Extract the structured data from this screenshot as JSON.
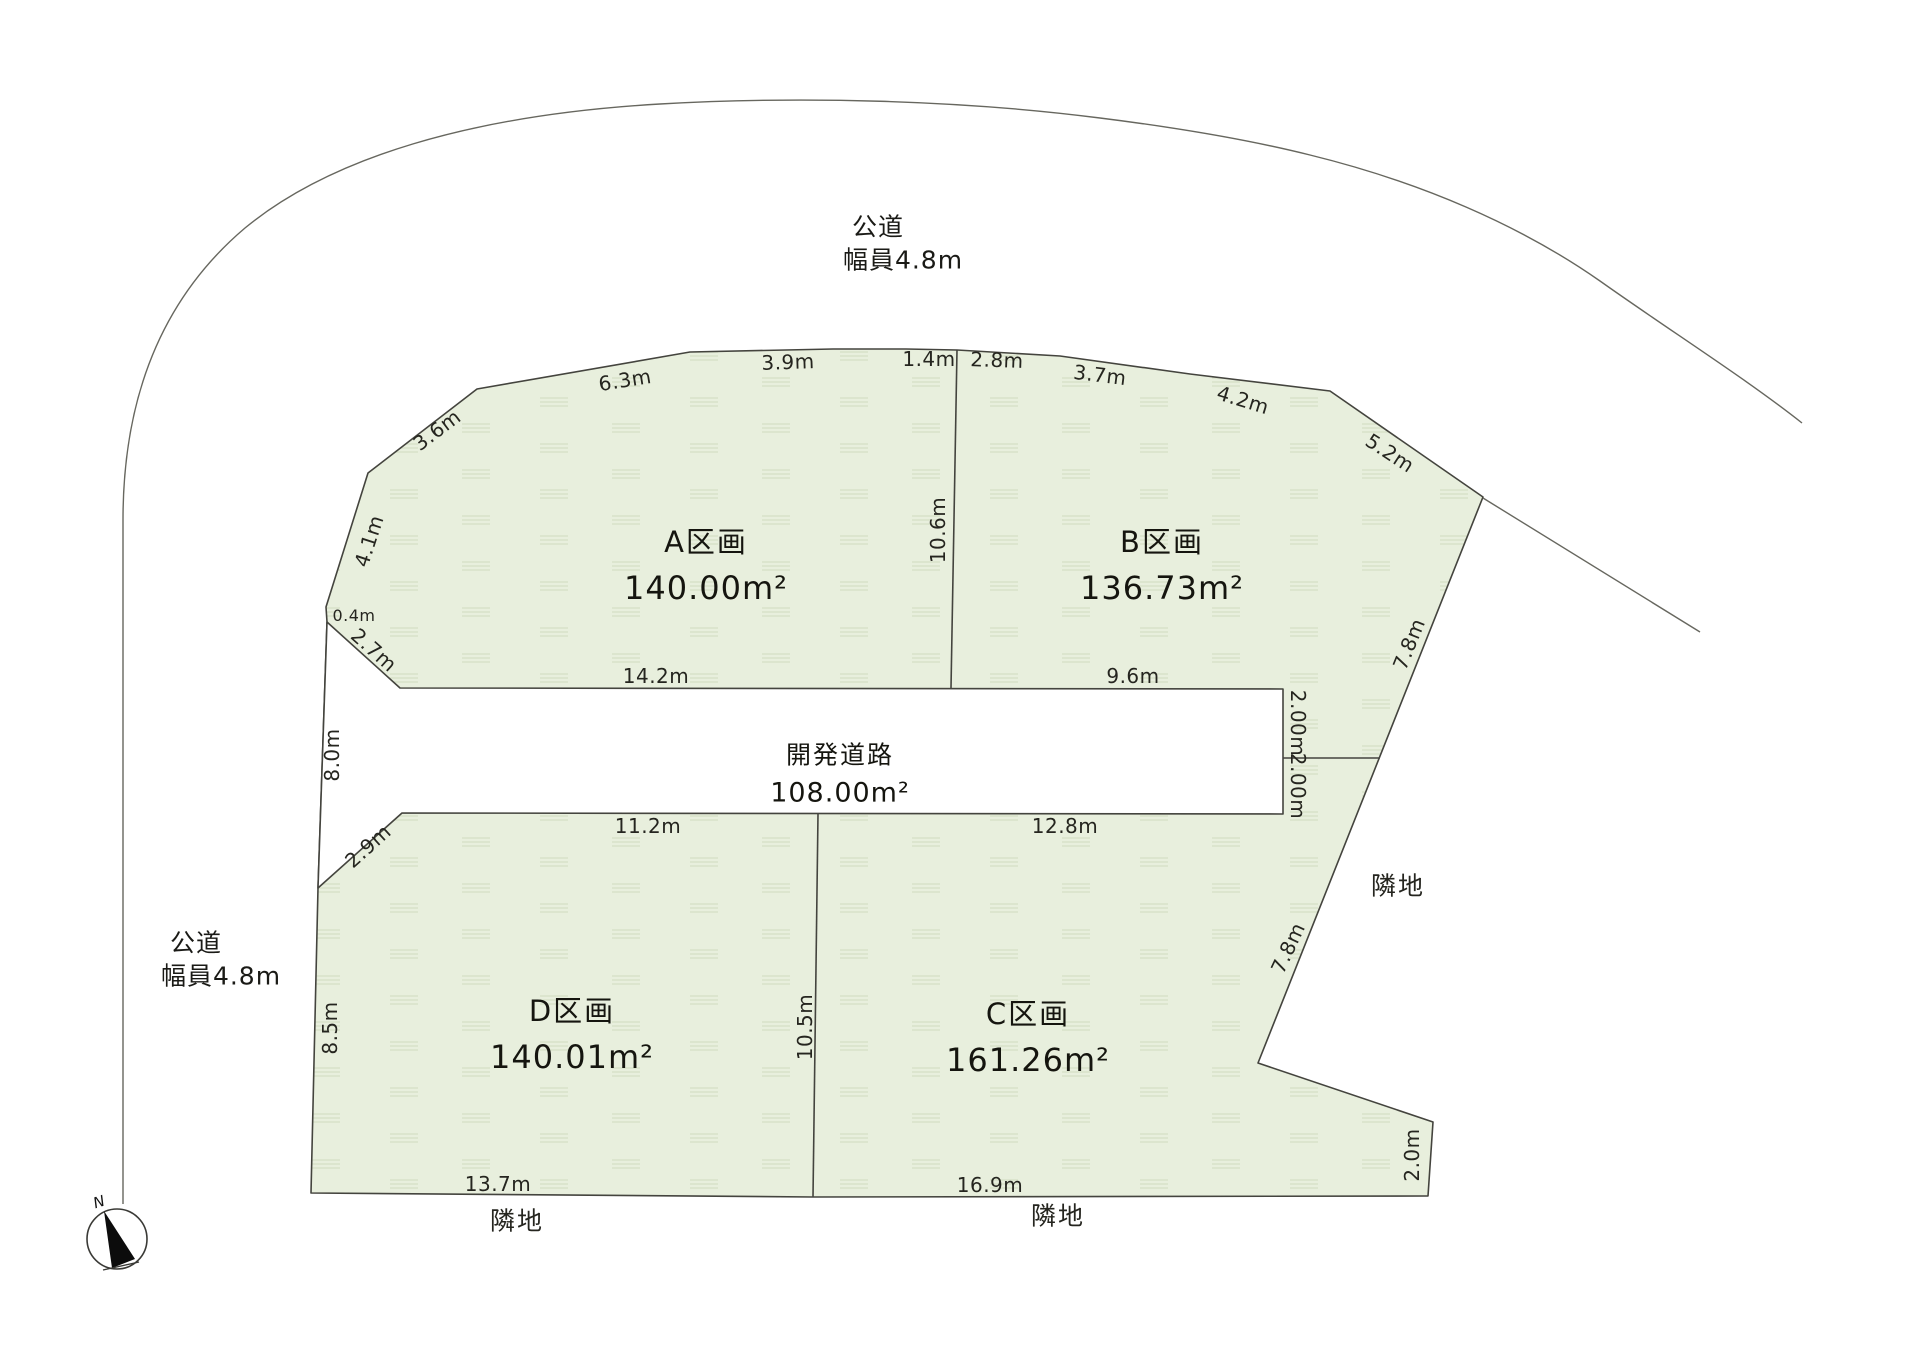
{
  "title": "区画図",
  "roads": {
    "public_top": {
      "name": "公道",
      "width": "幅員4.8m"
    },
    "public_left": {
      "name": "公道",
      "width": "幅員4.8m"
    },
    "development": {
      "name": "開発道路",
      "area": "108.00m²"
    }
  },
  "plots": {
    "a": {
      "name": "A区画",
      "area": "140.00m²"
    },
    "b": {
      "name": "B区画",
      "area": "136.73m²"
    },
    "c": {
      "name": "C区画",
      "area": "161.26m²"
    },
    "d": {
      "name": "D区画",
      "area": "140.01m²"
    }
  },
  "neighbors": {
    "bottom_left": "隣地",
    "bottom_right": "隣地",
    "right": "隣地"
  },
  "compass": {
    "north": "N"
  },
  "dims": {
    "top_6_3": "6.3m",
    "top_3_9": "3.9m",
    "top_1_4": "1.4m",
    "top_2_8": "2.8m",
    "top_3_7": "3.7m",
    "top_4_2": "4.2m",
    "right_5_2": "5.2m",
    "right_7_8_b": "7.8m",
    "left_3_6": "3.6m",
    "left_4_1": "4.1m",
    "left_0_4": "0.4m",
    "left_2_7": "2.7m",
    "a_bottom_14_2": "14.2m",
    "b_bottom_9_6": "9.6m",
    "divider_ab_10_6": "10.6m",
    "road_left_8_0": "8.0m",
    "left_2_9": "2.9m",
    "right_2_00_upper": "2.00m",
    "right_2_00_lower": "2.00m",
    "right_7_8_c": "7.8m",
    "d_left_8_5": "8.5m",
    "divider_dc_10_5": "10.5m",
    "d_top_11_2": "11.2m",
    "c_top_12_8": "12.8m",
    "d_bottom_13_7": "13.7m",
    "c_bottom_16_9": "16.9m",
    "c_right_2_0": "2.0m"
  },
  "colors": {
    "plot_fill": "#e8efdd",
    "plot_texture": "#d5dfc6",
    "plot_stroke": "#44443e",
    "outer_road_line": "#67675f"
  }
}
